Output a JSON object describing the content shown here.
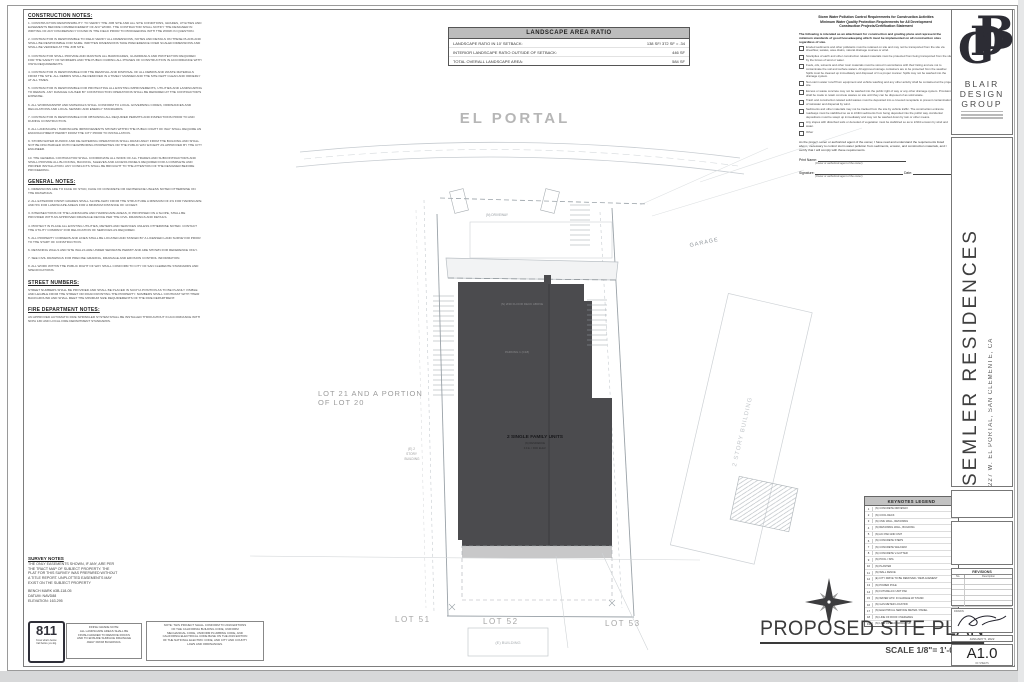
{
  "left_notes": {
    "sections": [
      {
        "heading": "CONSTRUCTION NOTES:",
        "body": "1.  CONSTRUCTION RESPONSIBILITY: TO VERIFY THE JOB SITE AND ALL SITE CONDITIONS, GRADES, UTILITIES AND EASEMENTS BEFORE COMMENCEMENT OF ANY WORK. THE CONTRACTOR SHALL NOTIFY THE DESIGNER IN WRITING OF ANY DISCREPANCY FOUND IN THE FIELD PRIOR TO PROCEEDING WITH THE WORK IN QUESTION.\n\n2.  CONTRACTOR IS RESPONSIBLE TO FIELD VERIFY ALL DIMENSIONS, NOTES AND DETAILS ON THESE PLANS AND SHALL BE RESPONSIBLE FOR SAME. WRITTEN DIMENSIONS TAKE PRECEDENCE OVER SCALED DIMENSIONS AND SHALL BE VERIFIED AT THE JOB SITE.\n\n3.  CONTRACTOR SHALL PROVIDE AND MAINTAIN ALL BARRICADES, GUARDRAILS AND PROTECTION REQUIRED FOR THE SAFETY OF WORKERS AND THE PUBLIC DURING ALL PHASES OF CONSTRUCTION IN ACCORDANCE WITH OSHA REQUIREMENTS.\n\n4.  CONTRACTOR IS RESPONSIBLE FOR THE REMOVAL AND DISPOSAL OF ALL DEBRIS AND WASTE MATERIALS FROM THE SITE. ALL DEBRIS SHALL BE REMOVED IN A TIMELY MANNER AND THE SITE KEPT CLEAN AND ORDERLY AT ALL TIMES.\n\n5.  CONTRACTOR IS RESPONSIBLE FOR PROTECTING ALL EXISTING IMPROVEMENTS, UTILITIES AND LANDSCAPING TO REMAIN. ANY DAMAGE CAUSED BY CONSTRUCTION OPERATIONS SHALL BE REPAIRED AT THE CONTRACTOR'S EXPENSE.\n\n6.  ALL WORKMANSHIP AND MATERIALS SHALL CONFORM TO LOCAL GOVERNING CODES, ORDINANCES AND REGULATIONS AND LOCAL SEISMIC AND ENERGY STANDARDS.\n\n7.  CONTRACTOR IS RESPONSIBLE FOR OBTAINING ALL REQUIRED PERMITS AND INSPECTIONS PRIOR TO AND DURING CONSTRUCTION.\n\n8.  ALL LANDSCAPE / HARDSCAPE IMPROVEMENTS SHOWN WITHIN THE PUBLIC RIGHT OF WAY SHALL REQUIRE AN ENCROACHMENT PERMIT FROM THE CITY PRIOR TO INSTALLATION.\n\n9.  STORM WATER RUNOFF AND DE-WATERING OPERATIONS SHALL DRAIN AWAY FROM THE BUILDING AND SHALL NOT BE DISCHARGED ONTO NEIGHBORING PROPERTIES OR THE PUBLIC WAY EXCEPT AS APPROVED BY THE CITY ENGINEER.\n\n10.  THE GENERAL CONTRACTOR SHALL COORDINATE ALL WORK OF ALL TRADES AND SUBCONTRACTORS AND SHALL PROVIDE ALL BLOCKING, BACKING, SLEEVES AND ACCESS PANELS REQUIRED FOR A COMPLETE AND PROPER INSTALLATION. ANY CONFLICTS SHALL BE BROUGHT TO THE ATTENTION OF THE DESIGNER BEFORE PROCEEDING."
      },
      {
        "heading": "GENERAL NOTES:",
        "body": "1.  DIMENSIONS ARE TO FACE OF STUD, FACE OF CONCRETE OR CENTERLINE UNLESS NOTED OTHERWISE ON THE DRAWINGS.\n\n2.  ALL EXTERIOR FINISH GRADES SHALL SLOPE AWAY FROM THE STRUCTURE A MINIMUM OF 2% FOR HARDSCAPE AND 5% FOR LANDSCAPE AREAS FOR A MINIMUM DISTANCE OF 10 FEET.\n\n3.  INTERSECTIONS OF THE LANDSCAPE AND HARDSCAPE AREAS, IF PROPOSED ON A SLOPE, SHALL BE PROVIDED WITH AN APPROVED DRAINAGE DEVICE PER THE CIVIL DRAWINGS AND DETAILS.\n\n4.  PROTECT IN PLACE ALL EXISTING UTILITIES, METERS AND SERVICES UNLESS OTHERWISE NOTED. CONTACT THE UTILITY COMPANY FOR RELOCATION OF SERVICES AS REQUIRED.\n\n5.  ALL PROPERTY CORNERS AND LINES SHALL BE LOCATED AND STAKED BY A LICENSED LAND SURVEYOR PRIOR TO THE START OF CONSTRUCTION.\n\n6.  RETAINING WALLS AND SITE WALLS ARE UNDER SEPARATE PERMIT AND ARE SHOWN FOR REFERENCE ONLY.\n\n7.  SEE CIVIL DRAWINGS FOR PRECISE GRADING, DRAINAGE AND EROSION CONTROL INFORMATION.\n\n8.  ALL WORK WITHIN THE PUBLIC RIGHT OF WAY SHALL CONFORM TO CITY OF SAN CLEMENTE STANDARDS AND SPECIFICATIONS."
      },
      {
        "heading": "STREET NUMBERS:",
        "body": "STREET NUMBERS SHALL BE PROVIDED AND SHALL BE PLACED IN SUCH A POSITION AS TO BE PLAINLY VISIBLE AND LEGIBLE FROM THE STREET OR ROAD FRONTING THE PROPERTY. NUMBERS SHALL CONTRAST WITH THEIR BACKGROUND AND SHALL MEET THE MINIMUM SIZE REQUIREMENTS OF THE FIRE DEPARTMENT."
      },
      {
        "heading": "FIRE DEPARTMENT NOTES:",
        "body": "AN APPROVED AUTOMATIC FIRE SPRINKLER SYSTEM SHALL BE INSTALLED THROUGHOUT IN ACCORDANCE WITH NFPA 13D AND LOCAL FIRE DEPARTMENT STANDARDS."
      }
    ]
  },
  "landscape_table": {
    "title": "LANDSCAPE AREA RATIO",
    "rows": [
      {
        "label": "LANDSCAPE RATIO IN 10' SETBACK:",
        "value": "138 SF/ 372 SF = .34"
      },
      {
        "label": "INTERIOR LANDSCAPE RATIO OUTSIDE OF SETBACK:",
        "value": "446 SF"
      },
      {
        "label": "TOTAL OVERALL LANDSCAPE AREA:",
        "value": "584 SF"
      }
    ]
  },
  "stormwater": {
    "heading": "Storm Water Pollution Control Requirements for Construction Activities\nMinimum Water Quality Protection Requirements for All Development\nConstruction Projects/Certification Statement",
    "intro": "The following is intended as an attachment for construction and grading plans and represent the minimum standards of good housekeeping which must be implemented on all construction sites regardless of size.",
    "items": [
      "Eroded sediments and other pollutants must be retained on site and may not be transported from the site via sheetflow, swales, area drains, natural drainage courses or wind.",
      "Stockpiles of earth and other construction related materials must be protected from being transported from the site by the forces of wind or water.",
      "Fuels, oils, solvents and other toxic materials must be stored in accordance with their listing and are not to contaminate the soil and surface waters. All approved storage containers are to be protected from the weather. Spills must be cleaned up immediately and disposed of in a proper manner. Spills may not be washed into the drainage system.",
      "Non-storm water runoff from equipment and vehicle washing and any other activity shall be contained at the project site.",
      "Excess or waste concrete may not be washed into the public right of way or any other drainage system. Provisions shall be made to retain concrete wastes on site until they can be disposed of as solid waste.",
      "Trash and construction related solid wastes must be deposited into a covered receptacle to prevent contamination of rainwater and dispersal by wind.",
      "Sediments and other materials may not be tracked from the site by vehicle traffic. The construction entrance roadways must be stabilized so as to inhibit sediments from being deposited into the public way. Accidental depositions must be swept up immediately and may not be washed down by rain or other means.",
      "Any slopes with disturbed soils or denuded of vegetation must be stabilized so as to inhibit erosion by wind and water.",
      "Other"
    ],
    "certification": "As the project owner or authorized agent of the owner, I have read and understand the requirements listed above, necessary to control storm water pollution from sediments, erosion, and construction materials, and I certify that I will comply with these requirements.",
    "print_name_label": "Print Name:",
    "signature_label": "Signature:",
    "date_label": "Date:",
    "owner_caption": "(Owner or authorized agent of the owner)"
  },
  "plan": {
    "street_name": "EL PORTAL",
    "driveway_label": "(N) DRIVEWAY",
    "garage_label": "GARAGE",
    "neighbor_label": "2 STORY BUILDING",
    "lot2021_line1": "LOT 21 AND A PORTION",
    "lot2021_line2": "OF LOT 20",
    "existing": [
      "(E) 2",
      "STORY",
      "BUILDING"
    ],
    "note1": "(N) 2ND FLOOR DECK ABOVE",
    "note2": "PARKING 1  (C18)",
    "footprint_label": "2 SINGLE FAMILY UNITS",
    "footprint_sub1": "(N) RESIDENCE",
    "footprint_sub2": "F.F.E. / PAD ELEV.",
    "lot51": "LOT 51",
    "lot52": "LOT 52",
    "lot53": "LOT 53",
    "building_box_label": "(E) BUILDING"
  },
  "keynotes": {
    "title": "KEYNOTES LEGEND",
    "items": [
      "(N) CONCRETE DRIVEWAY",
      "(N) COOL DECK",
      "(N) CMU WALL, RETAINING",
      "(N) RETAINING WALL, BUILDING",
      "(N) A/C PAD AND UNIT",
      "(N) CONCRETE STEPS",
      "(N) CONCRETE WALKWAY",
      "(N) CONCRETE V-GUTTER",
      "(N) POOL / SPA",
      "(N) PLANTER",
      "(N) WALL FENCE",
      "(E) CITY DRIVE TO BE REMOVED / REPLACEMENT",
      "(N) POWER POLE",
      "(N) FUTURE A/C UNIT PAD",
      "(N) WATER HTR. IN GARAGE W/ STAND",
      "(N) GAS METER LOCATION",
      "(N) ELECTRICAL SERVICE METER / PANEL",
      "(N) LINE OF ROOF OVERHANG",
      "(N) LINE OF DECK/WALLS UP"
    ]
  },
  "survey": {
    "heading": "SURVEY NOTES",
    "body": "THE ONLY EASEMENTS SHOWN, IF ANY, ARE PER\nTHE TRACT MAP OF SUBJECT PROPERTY.  THE\nPLAT FOR THIS SURVEY WAS PREPARED WITHOUT\nA TITLE REPORT.  UNPLOTTED EASEMENTS MAY\nEXIST ON THE SUBJECT PROPERTY",
    "bench_mark": "BENCH MARK #3B-118-05",
    "datum": "DATUM: NAVD88",
    "elevation": "ELEVATION: 163.295"
  },
  "bottom_row": {
    "call811": {
      "number": "811",
      "tagline1": "Know what's below.",
      "tagline2": "Call before you dig."
    },
    "finish_grade_note": "FINISH GRADE NOTE:\nALL LANDSCAPE AREAS SHALL BE\nFINISH GRADED TO REMOVE ROCKS\nAND TO ENSURE SURFACE DRAINAGE\nAWAY FROM BUILDINGS.",
    "code_note": "NOTE: THIS PROJECT SHALL CONFORM TO 2019 EDITIONS\nOF THE CALIFORNIA BUILDING CODE, UNIFORM\nMECHANICAL CODE, UNIFORM PLUMBING CODE, AND\nCALIFORNIA ELECTRICAL CODE BASE ON THE 2019 EDITION\nOF THE NATIONAL ELECTRIC CODE, AND CITY AND COUNTY\nLAWS AND ORDINANCES."
  },
  "titlebar": {
    "title": "PROPOSED SITE PLAN",
    "scale": "SCALE 1/8\"= 1'-0\""
  },
  "titleblock": {
    "monogram": {
      "b": "B",
      "d": "D",
      "g": "G"
    },
    "firm_name_lines": [
      "BLAIR",
      "DESIGN",
      "GROUP"
    ],
    "project_title": "SEMLER RESIDENCES",
    "project_address": "227 W. EL PORTAL, SAN CLEMENTE, CA",
    "revisions_title": "REVISIONS",
    "revisions_cols": [
      "No.",
      "Description"
    ],
    "drawn_label": "DRAWN",
    "date_text": "JANUARY 5, 2022",
    "sheet_number": "A1.0",
    "sheet_caption": "OF SHEETS"
  },
  "colors": {
    "footprint": "#4b4b4e",
    "faint_line": "#c6cbd0",
    "mid_line": "#9aa2a8",
    "street_text": "#b6b6b6"
  }
}
